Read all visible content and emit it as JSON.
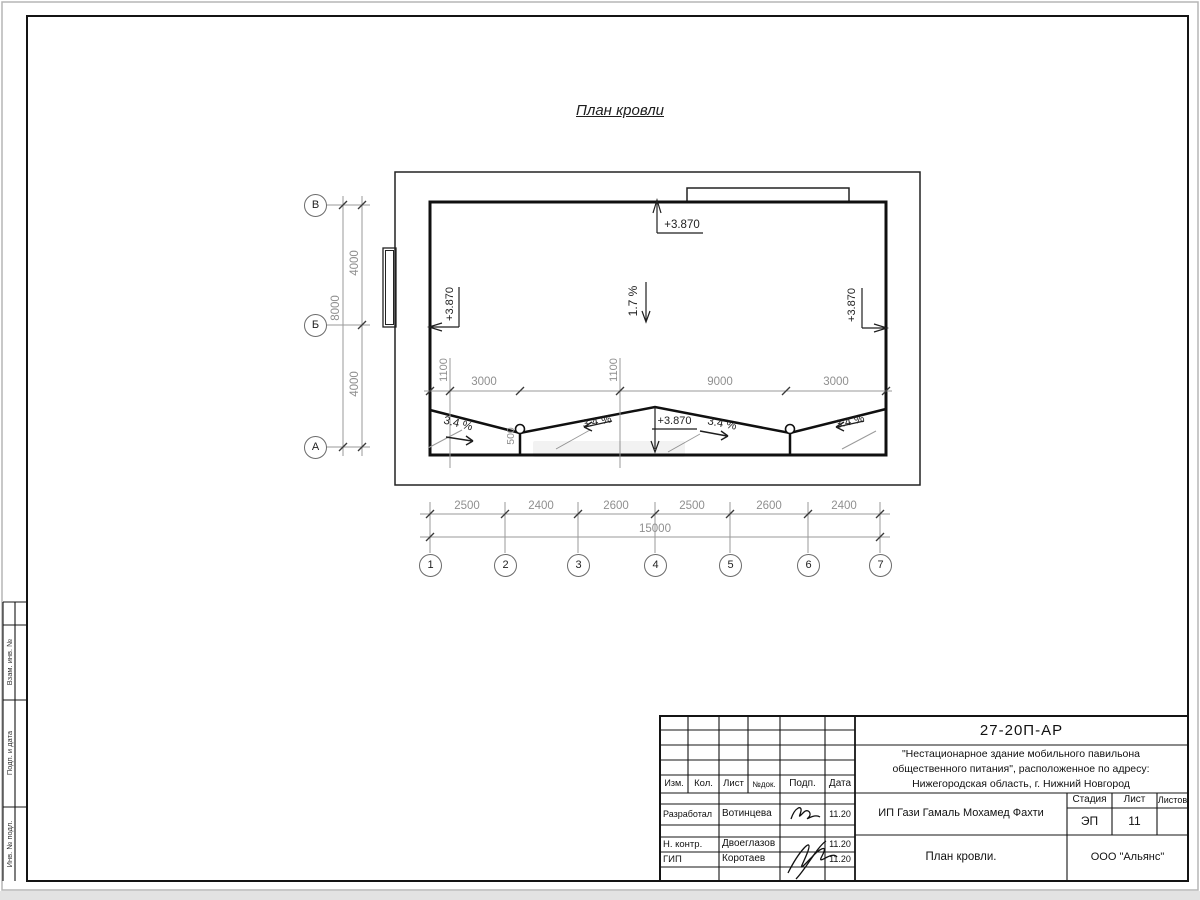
{
  "sheet": {
    "title": "План кровли",
    "side_strip": [
      "Взам. инв. №",
      "Подп. и дата",
      "Инв. № подл."
    ]
  },
  "plan": {
    "elevation_top": "+3.870",
    "elevation_left": "+3.870",
    "elevation_right": "+3.870",
    "elevation_ridge": "+3.870",
    "slope_main": "1.7 %",
    "slopes": [
      "3.4 %",
      "3.4 %",
      "3.4 %",
      "3.4 %"
    ],
    "axis_rows": [
      "В",
      "Б",
      "А"
    ],
    "dims_left": [
      "4000",
      "4000"
    ],
    "dim_left_total": "8000",
    "dims_inner": {
      "a1100": "1100",
      "a3000": "3000",
      "b1100": "1100",
      "b9000": "9000",
      "c3000": "3000"
    },
    "dim_500": "500",
    "columns": [
      "1",
      "2",
      "3",
      "4",
      "5",
      "6",
      "7"
    ],
    "bottom_dims": [
      "2500",
      "2400",
      "2600",
      "2500",
      "2600",
      "2400"
    ],
    "total_dim": "15000"
  },
  "title_block": {
    "doc_number": "27-20П-АР",
    "project_name": "\"Нестационарное здание мобильного павильона общественного питания\", расположенное по адресу: Нижегородская область, г. Нижний Новгород",
    "columns": {
      "izm": "Изм.",
      "kol": "Кол.",
      "list": "Лист",
      "ndoc": "№док.",
      "podp": "Подп.",
      "data": "Дата"
    },
    "rows": [
      {
        "role": "Разработал",
        "name": "Вотинцева",
        "date": "11.20"
      },
      {
        "role": "Н. контр.",
        "name": "Двоеглазов",
        "date": "11.20"
      },
      {
        "role": "ГИП",
        "name": "Коротаев",
        "date": "11.20"
      }
    ],
    "client": "ИП Гази Гамаль Мохамед Фахти",
    "stage_label": "Стадия",
    "sheet_label": "Лист",
    "sheets_label": "Листов",
    "stage": "ЭП",
    "sheet_number": "11",
    "drawing_title": "План кровли.",
    "company": "ООО \"Альянс\""
  }
}
